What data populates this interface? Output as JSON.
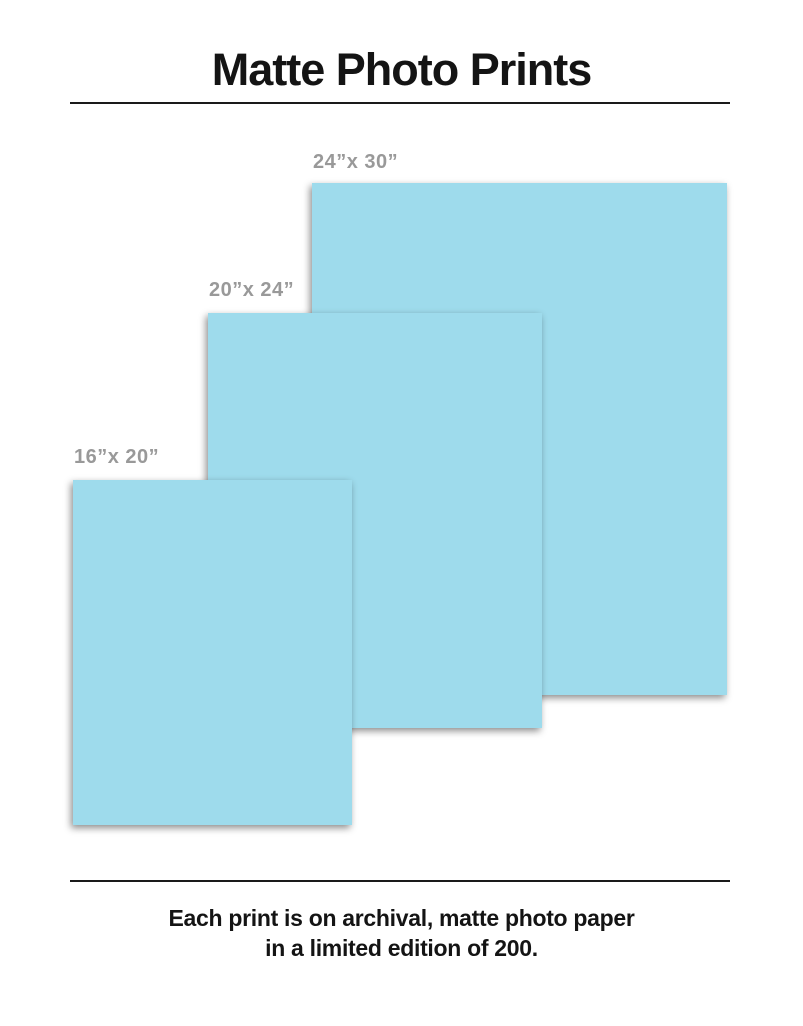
{
  "header": {
    "title": "Matte Photo Prints"
  },
  "prints": [
    {
      "id": "24x30",
      "label": "24”x 30”",
      "width_in": 24,
      "height_in": 30
    },
    {
      "id": "20x24",
      "label": "20”x 24”",
      "width_in": 20,
      "height_in": 24
    },
    {
      "id": "16x20",
      "label": "16”x 20”",
      "width_in": 16,
      "height_in": 20
    }
  ],
  "footer": {
    "line1": "Each print is on archival, matte photo paper",
    "line2": "in a limited edition of 200."
  },
  "colors": {
    "print_fill": "#9EDBEC",
    "label_text": "#999999",
    "text": "#141414",
    "rule": "#1a1a1a"
  }
}
